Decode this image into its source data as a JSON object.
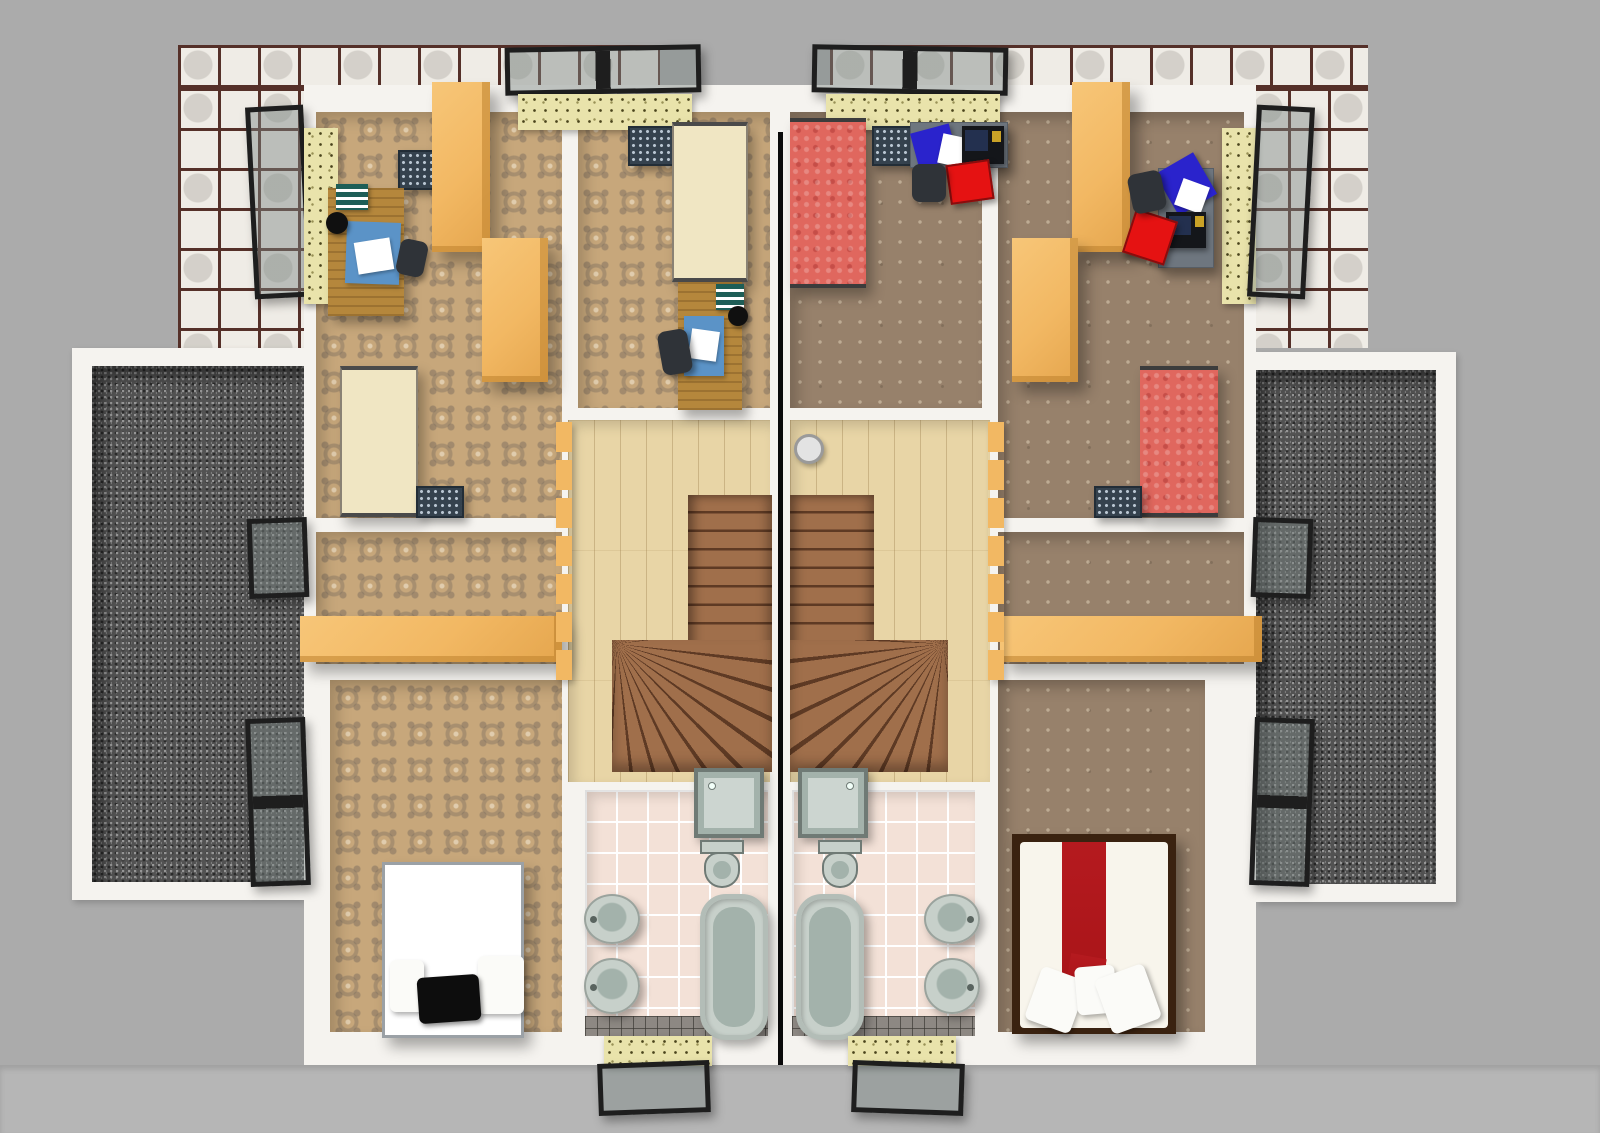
{
  "meta": {
    "type": "3d-floor-plan-render",
    "view": "top-down",
    "description": "Upper floor of a semi-detached duplex house, two mirrored units divided by a black party wall, rendered from above with furniture"
  },
  "palette": {
    "bg": "#ababab",
    "roofBand": "#b6b6b6",
    "wall": "#f5f3ef",
    "cobbleTile": "#efece6",
    "cobbleJoint": "#553029",
    "gravelBase": "#525252",
    "gravelLight": "#989898",
    "gravelDark": "#2b2b2b",
    "carpetLBase": "#c7a77b",
    "carpetRBase": "#97816b",
    "wood": "#e8d5a6",
    "stair": "#a06f4b",
    "stairLine": "#5e3a24",
    "bathTile": "#f3e1d7",
    "grout": "#ffffff",
    "bathDark": "#8d8883",
    "fixture": "#c7d0ca",
    "fixtureDeep": "#a3b2ab",
    "fixtureEdge": "#6f7a75",
    "sill": "#e9e3ab",
    "sillDot": "#4a441c",
    "frame": "#1e1e1e",
    "glass": "rgba(125,135,133,0.45)",
    "orange": "#f2b863",
    "deskWood": "#b5873c",
    "deskGray": "#6e767f",
    "cream": "#f0e6c3",
    "redBed": "#e0675e",
    "redRunner": "#a81418",
    "bedBrown": "#3a2210",
    "blue": "#2a23cc",
    "blueRug": "#5b93c7",
    "chairRed": "#e51212",
    "chairDark": "#2f3338",
    "radiator": "#35424e",
    "radiatorDot": "#b9c6d2",
    "white": "#ffffff",
    "black": "#0a0a0a"
  },
  "scene": {
    "exterior": [
      "cobblestone-paving-top",
      "gravel-roof-terrace-left",
      "gravel-roof-terrace-right",
      "white-parapet-walls",
      "gray-roof-surround"
    ],
    "units": [
      {
        "side": "left",
        "floor_finish": "patterned-damask-carpet",
        "rooms": [
          {
            "name": "child-room-front-left",
            "items": [
              "open-casement-window",
              "radiator",
              "wooden-desk",
              "blue-desk-pad",
              "white-paper",
              "striped-books",
              "black-lamp",
              "desk-chair",
              "tall-orange-wardrobe",
              "orange-dresser",
              "cream-single-bed"
            ]
          },
          {
            "name": "child-room-front-right",
            "items": [
              "roof-skylight",
              "radiator",
              "cream-single-bed",
              "wooden-desk",
              "blue-desk-pad",
              "striped-books",
              "black-chair"
            ]
          },
          {
            "name": "middle-room",
            "items": [
              "open-window",
              "long-orange-sideboard"
            ]
          },
          {
            "name": "rear-bedroom",
            "items": [
              "double-open-window",
              "white-double-bed",
              "black-pillow",
              "white-pillows"
            ]
          },
          {
            "name": "stair-hall",
            "items": [
              "wood-landing",
              "orange-balustrade",
              "straight-stair-flight",
              "winder-steps"
            ]
          },
          {
            "name": "bathroom",
            "items": [
              "shower-cabin",
              "toilet",
              "wash-basin",
              "wash-basin",
              "bathtub",
              "roof-skylight-bottom",
              "stone-sill"
            ]
          }
        ]
      },
      {
        "side": "right",
        "floor_finish": "brown-dotted-carpet",
        "rooms": [
          {
            "name": "child-room-front-left",
            "items": [
              "roof-skylight",
              "red-single-bed",
              "radiator",
              "gray-desk",
              "laptop",
              "blue-notebook",
              "white-paper",
              "red-chair",
              "black-chair"
            ]
          },
          {
            "name": "child-room-front-right",
            "items": [
              "open-casement-window",
              "tall-orange-wardrobe",
              "orange-dresser",
              "gray-desk",
              "laptop",
              "blue-notebook",
              "red-chair",
              "black-chair",
              "red-single-bed",
              "radiator"
            ]
          },
          {
            "name": "middle-room",
            "items": [
              "open-window",
              "long-orange-sideboard"
            ]
          },
          {
            "name": "rear-bedroom",
            "items": [
              "double-open-window",
              "brown-frame-double-bed",
              "white-duvet",
              "red-runner",
              "white-pillows"
            ]
          },
          {
            "name": "stair-hall",
            "items": [
              "wood-landing",
              "orange-balustrade",
              "straight-stair-flight",
              "winder-steps",
              "white-round-basket"
            ]
          },
          {
            "name": "bathroom",
            "items": [
              "shower-cabin",
              "toilet",
              "bathtub",
              "wash-basin",
              "wash-basin",
              "roof-skylight-bottom",
              "stone-sill"
            ]
          }
        ]
      }
    ],
    "party_wall": "black-dividing-line"
  }
}
